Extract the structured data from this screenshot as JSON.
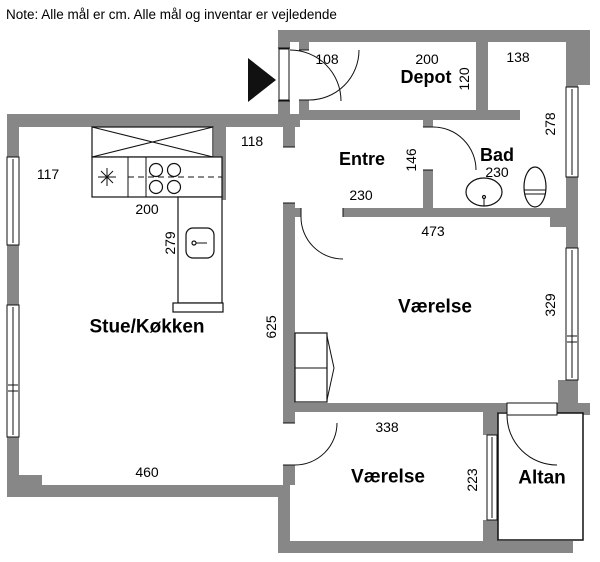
{
  "note": "Note: Alle mål er cm. Alle mål og inventar er vejledende",
  "colors": {
    "wall": "#878787",
    "line": "#111111",
    "background": "#ffffff"
  },
  "rooms": {
    "stue": {
      "label": "Stue/Køkken"
    },
    "entre": {
      "label": "Entre"
    },
    "depot": {
      "label": "Depot"
    },
    "bad": {
      "label": "Bad"
    },
    "vaerelse_top": {
      "label": "Værelse"
    },
    "vaerelse_bottom": {
      "label": "Værelse"
    },
    "altan": {
      "label": "Altan"
    }
  },
  "measurements": {
    "entry_door": "108",
    "depot_width": "200",
    "depot_depth": "120",
    "niche_width": "138",
    "bad_depth": "278",
    "passage_width": "118",
    "kitchen_offset": "117",
    "entre_width": "146",
    "bad_width": "230",
    "entre_depth": "230",
    "vaerelse_top_width": "473",
    "kitchen_counter": "200",
    "kitchen_island": "279",
    "stue_depth": "625",
    "vaerelse_top_depth": "329",
    "stue_width": "460",
    "vaerelse_bottom_width": "338",
    "vaerelse_bottom_depth": "223"
  }
}
